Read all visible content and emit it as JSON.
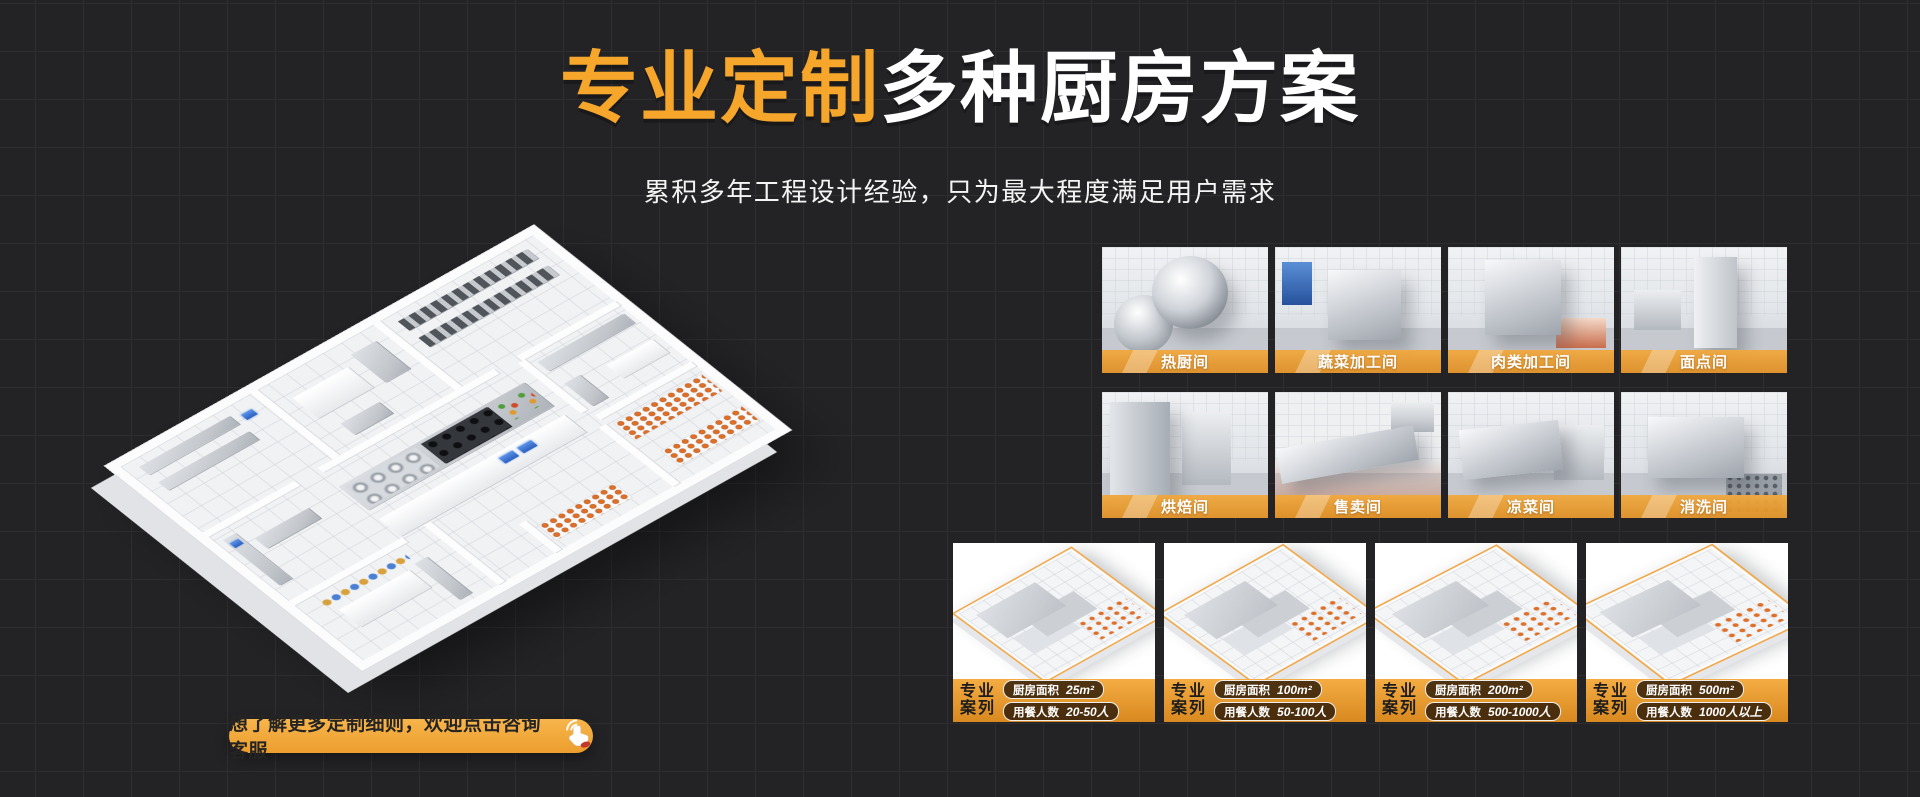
{
  "hero": {
    "title_highlight": "专业定制",
    "title_rest": "多种厨房方案",
    "subtitle": "累积多年工程设计经验，只为最大程度满足用户需求"
  },
  "rooms": {
    "labels": [
      "热厨间",
      "蔬菜加工间",
      "肉类加工间",
      "面点间",
      "烘焙间",
      "售卖间",
      "凉菜间",
      "消洗间"
    ]
  },
  "cases": {
    "tag_line1": "专业",
    "tag_line2": "案列",
    "area_label": "厨房面积",
    "diners_label": "用餐人数",
    "items": [
      {
        "area": "25m²",
        "diners": "20-50人"
      },
      {
        "area": "100m²",
        "diners": "50-100人"
      },
      {
        "area": "200m²",
        "diners": "500-1000人"
      },
      {
        "area": "500m²",
        "diners": "1000人以上"
      }
    ]
  },
  "cta": {
    "label": "想了解更多定制细则，欢迎点击咨询客服",
    "icon": "click-hand-icon"
  },
  "colors": {
    "background": "#232326",
    "grid_line": "#2E2E31",
    "accent_orange": "#F5A62B",
    "banner_orange": "#E99B33",
    "footer_orange_top": "#F4AC43",
    "footer_orange_bottom": "#D8891F",
    "badge_dark": "#2A1907",
    "text_white": "#FFFFFF",
    "cta_text_dark": "#242424"
  }
}
